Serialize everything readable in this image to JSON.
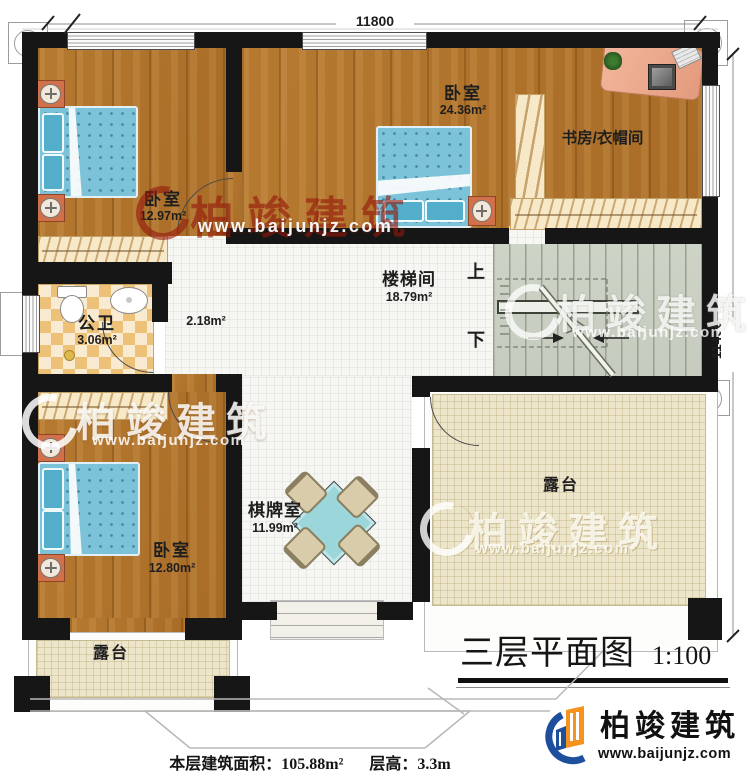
{
  "dimensions": {
    "top": "11800",
    "right": "11450"
  },
  "rooms": {
    "bedroom_top_left": {
      "name": "卧室",
      "area": "12.97m²"
    },
    "bedroom_top": {
      "name": "卧室",
      "area": "24.36m²"
    },
    "study_cloakroom": {
      "name": "书房/衣帽间"
    },
    "stair_hall": {
      "name": "楼梯间",
      "area": "18.79m²"
    },
    "hallway": {
      "area": "2.18m²"
    },
    "bathroom": {
      "name": "公卫",
      "area": "3.06m²"
    },
    "bedroom_bottom_left": {
      "name": "卧室",
      "area": "12.80m²"
    },
    "game_room": {
      "name": "棋牌室",
      "area": "11.99m²"
    },
    "terrace_right": {
      "name": "露台"
    },
    "terrace_left": {
      "name": "露台"
    }
  },
  "stairs": {
    "up_label": "上",
    "down_label": "下"
  },
  "title": {
    "text": "三层平面图",
    "scale": "1:100"
  },
  "footer": {
    "floor_area": "本层建筑面积：105.88m²",
    "floor_height": "层高：3.3m"
  },
  "brand": {
    "name": "柏竣建筑",
    "url": "www.baijunjz.com"
  },
  "watermark": {
    "name": "柏竣建筑",
    "url": "www.baijunjz.com"
  },
  "colors": {
    "wall": "#161616",
    "wood": "#b1752e",
    "tile": "#f6f6f3",
    "stairs_floor": "#cdd3c7",
    "terrace": "#ece5ca",
    "bathroom_tile": "#eec179",
    "bed": "#7cc3d9",
    "watermark_red": "#96190f",
    "brand_blue": "#1d4f9c",
    "brand_orange": "#f6921e"
  }
}
